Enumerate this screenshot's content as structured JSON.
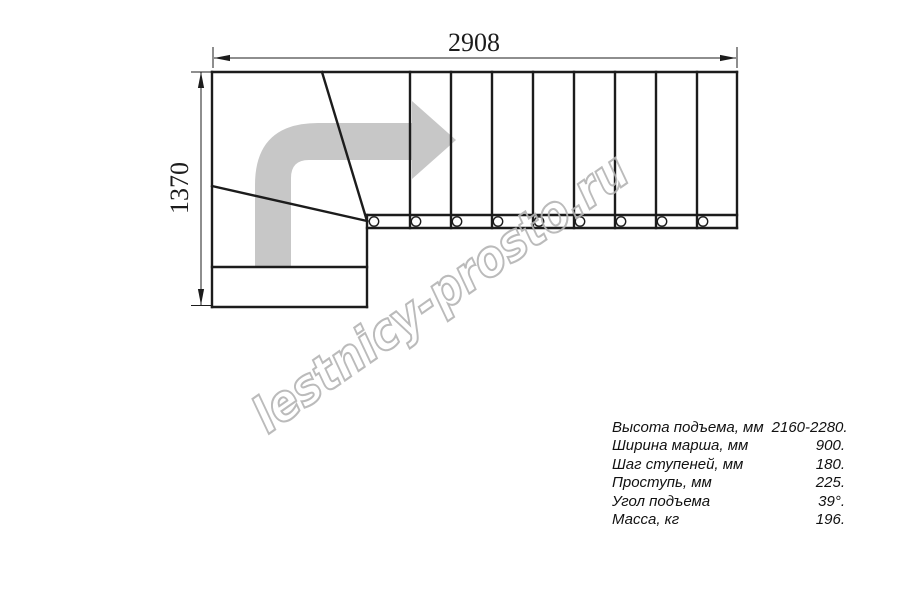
{
  "drawing": {
    "title": "staircase-plan-view",
    "dim_width_label": "2908",
    "dim_height_label": "1370",
    "watermark": "lestnicy-prosto.ru"
  },
  "specs": {
    "rows": [
      {
        "label": "Высота подъема, мм",
        "value": "2160-2280."
      },
      {
        "label": "Ширина марша, мм",
        "value": "900."
      },
      {
        "label": "Шаг ступеней, мм",
        "value": "180."
      },
      {
        "label": "Проступь, мм",
        "value": "225."
      },
      {
        "label": "Угол подъема",
        "value": "39°."
      },
      {
        "label": "Масса, кг",
        "value": "196."
      }
    ]
  },
  "colors": {
    "line": "#1c1c1c",
    "arrow": "#c7c7c7",
    "watermark_outline": "#b4b4b4"
  }
}
